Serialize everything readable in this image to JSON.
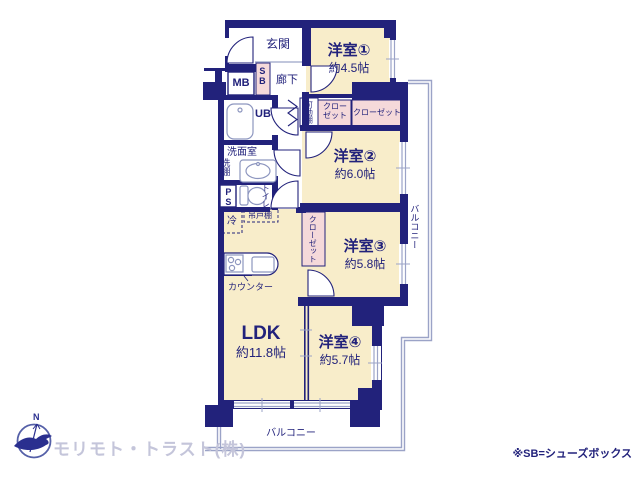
{
  "rooms": {
    "western1": {
      "name": "洋室①",
      "size": "約4.5帖"
    },
    "western2": {
      "name": "洋室②",
      "size": "約6.0帖"
    },
    "western3": {
      "name": "洋室③",
      "size": "約5.8帖"
    },
    "western4": {
      "name": "洋室④",
      "size": "約5.7帖"
    },
    "ldk": {
      "name": "LDK",
      "size": "約11.8帖"
    }
  },
  "labels": {
    "entrance": "玄関",
    "corridor": "廊下",
    "mb": "MB",
    "sb": "SB",
    "ub": "UB",
    "washroom": "洗面室",
    "laundry_shelf": "洗棚",
    "ps": "PS",
    "toilet": "トイレ",
    "fridge": "冷",
    "hanging_cupboard": "吊戸棚",
    "counter": "カウンター",
    "movable_shelf": "可動棚",
    "closet_a": "クローゼット",
    "closet_b": "クローゼット",
    "closet_c": "クローゼット",
    "balcony_right": "バルコニー",
    "balcony_bottom": "バルコニー"
  },
  "footer": {
    "company": "モリモト・トラスト(株)",
    "note": "※SB=シューズボックス",
    "logo_letter": "N"
  },
  "colors": {
    "wall": "#22227b",
    "room_cream": "#f8edca",
    "closet_pink": "#f5d9da",
    "thin_line": "#9ba3c7",
    "text": "#22227b",
    "company_text": "#c4c5da"
  }
}
